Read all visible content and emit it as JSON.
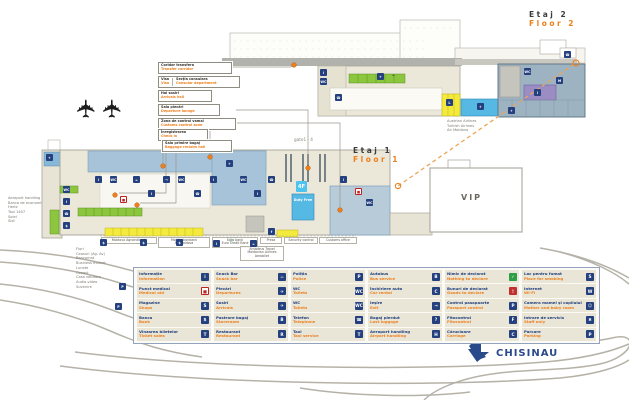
{
  "floors": {
    "floor2": {
      "ro": "Etaj 2",
      "en": "Floor 2"
    },
    "floor1": {
      "ro": "Etaj 1",
      "en": "Floor 1"
    }
  },
  "callouts": [
    {
      "ro": "Coridor transfera",
      "en": "Transfer corridor"
    },
    {
      "ro": "Visa",
      "en": "Visa",
      "ro2": "Secția consulara",
      "en2": "Consular department"
    },
    {
      "ro": "Hol sosiri",
      "en": "Arrivals hall"
    },
    {
      "ro": "Sala plecări",
      "en": "Departure lounge"
    },
    {
      "ro": "Zona de control vamal",
      "en": "Customs control zone"
    },
    {
      "ro": "Înregistrarea",
      "en": "Check in"
    },
    {
      "ro": "Sala primire bagaj",
      "en": "Baggage reclaim hall"
    }
  ],
  "annotations": {
    "gate_label": "gate1 - 4",
    "vip": "VIP",
    "city": "CHISINAU",
    "duty_free": "Duty Free",
    "airlines_note": [
      "Austrian Airlines",
      "Turkish Airlines",
      "Air Moldova"
    ],
    "services_list": [
      "Aeroport handling",
      "Banca de economii",
      "Hertz",
      "Taxi 1407",
      "Solei",
      "Sixt"
    ],
    "shops_list": [
      "Flori",
      "Ceasuri (Ag. Av)",
      "Bancomat",
      "Business market"
    ],
    "shops_list2": [
      "Lunete",
      "Conact",
      "Casa valutara",
      "Audio-video",
      "Suvenire"
    ],
    "tenant_labels": [
      {
        "lines": [
          "Moldova Agroindbank"
        ]
      },
      {
        "lines": [
          "Moldindconbank",
          "Air Moldova"
        ]
      },
      {
        "lines": [
          "Euro bank",
          "Euro Credit Bank"
        ]
      },
      {
        "lines": [
          "Presa"
        ]
      },
      {
        "lines": [
          "Amadeus Travel",
          "Moldavian Airlines",
          "Aerobilet"
        ]
      },
      {
        "lines": [
          "Security control"
        ]
      },
      {
        "lines": [
          "Customs office"
        ]
      }
    ]
  },
  "legend": {
    "columns": [
      {
        "items": [
          {
            "ro": "Informație",
            "en": "Information",
            "icon": "information",
            "glyph": "i",
            "bg": "#24407e",
            "fg": "#ffffff"
          },
          {
            "ro": "Punct medical",
            "en": "Medical aid",
            "icon": "medical-aid",
            "glyph": "■",
            "bg": "#ffffff",
            "fg": "#c02222"
          },
          {
            "ro": "Magazine",
            "en": "Shops",
            "icon": "shops",
            "glyph": "S",
            "bg": "#24407e",
            "fg": "#ffffff"
          },
          {
            "ro": "Banca",
            "en": "Bank",
            "icon": "bank",
            "glyph": "$",
            "bg": "#24407e",
            "fg": "#ffffff"
          },
          {
            "ro": "Vînzarea biletelor",
            "en": "Ticket sales",
            "icon": "ticket-sales",
            "glyph": "T",
            "bg": "#24407e",
            "fg": "#ffffff"
          }
        ]
      },
      {
        "items": [
          {
            "ro": "Snack Bar",
            "en": "Snack bar",
            "icon": "snack-bar",
            "glyph": "☕",
            "bg": "#24407e",
            "fg": "#ffffff"
          },
          {
            "ro": "Plecări",
            "en": "Departures",
            "icon": "departures",
            "glyph": "✈",
            "bg": "#24407e",
            "fg": "#ffffff"
          },
          {
            "ro": "Sosiri",
            "en": "Arrivals",
            "icon": "arrivals",
            "glyph": "✈",
            "bg": "#24407e",
            "fg": "#ffffff"
          },
          {
            "ro": "Pastrare bagaj",
            "en": "Storeroom",
            "icon": "luggage-storage",
            "glyph": "B",
            "bg": "#24407e",
            "fg": "#ffffff"
          },
          {
            "ro": "Restaurant",
            "en": "Restaurant",
            "icon": "restaurant",
            "glyph": "R",
            "bg": "#24407e",
            "fg": "#ffffff"
          }
        ]
      },
      {
        "items": [
          {
            "ro": "Poliția",
            "en": "Police",
            "icon": "police",
            "glyph": "P",
            "bg": "#24407e",
            "fg": "#ffffff"
          },
          {
            "ro": "WC",
            "en": "Toilets",
            "icon": "wc-men",
            "glyph": "WC",
            "bg": "#24407e",
            "fg": "#ffffff"
          },
          {
            "ro": "WC",
            "en": "Toilets",
            "icon": "wc-women",
            "glyph": "WC",
            "bg": "#24407e",
            "fg": "#ffffff"
          },
          {
            "ro": "Telefon",
            "en": "Telephone",
            "icon": "telephone",
            "glyph": "☎",
            "bg": "#24407e",
            "fg": "#ffffff"
          },
          {
            "ro": "Taxi",
            "en": "Taxi service",
            "icon": "taxi",
            "glyph": "T",
            "bg": "#24407e",
            "fg": "#ffffff"
          }
        ]
      },
      {
        "items": [
          {
            "ro": "Autobus",
            "en": "Bus service",
            "icon": "bus",
            "glyph": "B",
            "bg": "#24407e",
            "fg": "#ffffff"
          },
          {
            "ro": "Închiriere auto",
            "en": "Car rental",
            "icon": "car-rental",
            "glyph": "C",
            "bg": "#24407e",
            "fg": "#ffffff"
          },
          {
            "ro": "Ieşire",
            "en": "Exit",
            "icon": "exit",
            "glyph": "→",
            "bg": "#24407e",
            "fg": "#ffffff"
          },
          {
            "ro": "Bagaj pierdut",
            "en": "Lost luggage",
            "icon": "lost-luggage",
            "glyph": "?",
            "bg": "#24407e",
            "fg": "#ffffff"
          },
          {
            "ro": "Aeroport handling",
            "en": "Airport handling",
            "icon": "airport-handling",
            "glyph": "H",
            "bg": "#24407e",
            "fg": "#ffffff"
          }
        ]
      },
      {
        "items": [
          {
            "ro": "Nimic de declarat",
            "en": "Nothing to declare",
            "icon": "nothing-to-declare",
            "glyph": "✓",
            "bg": "#2f9e44",
            "fg": "#ffffff"
          },
          {
            "ro": "Bunuri de declarat",
            "en": "Goods to declare",
            "icon": "goods-to-declare",
            "glyph": "!",
            "bg": "#c03030",
            "fg": "#ffffff"
          },
          {
            "ro": "Control pasapoarte",
            "en": "Passport control",
            "icon": "passport-control",
            "glyph": "P",
            "bg": "#24407e",
            "fg": "#ffffff"
          },
          {
            "ro": "Fitocontrol",
            "en": "Fitocontrol",
            "icon": "fitocontrol",
            "glyph": "F",
            "bg": "#24407e",
            "fg": "#ffffff"
          },
          {
            "ro": "Cărucioare",
            "en": "Carriage",
            "icon": "trolleys",
            "glyph": "C",
            "bg": "#24407e",
            "fg": "#ffffff"
          }
        ]
      },
      {
        "items": [
          {
            "ro": "Loc pentru fumat",
            "en": "Place for smoking",
            "icon": "smoking-area",
            "glyph": "S",
            "bg": "#24407e",
            "fg": "#ffffff"
          },
          {
            "ro": "Internet",
            "en": "Wi-Fi",
            "icon": "wifi",
            "glyph": "W",
            "bg": "#24407e",
            "fg": "#ffffff"
          },
          {
            "ro": "Camera mamei şi copilului",
            "en": "Mother and baby room",
            "icon": "mother-baby-room",
            "glyph": "☺",
            "bg": "#24407e",
            "fg": "#ffffff"
          },
          {
            "ro": "Intrare de serviciu",
            "en": "Staff only",
            "icon": "staff-entrance",
            "glyph": "✖",
            "bg": "#24407e",
            "fg": "#ffffff"
          },
          {
            "ro": "Parcare",
            "en": "Parking",
            "icon": "parking",
            "glyph": "P",
            "bg": "#24407e",
            "fg": "#ffffff"
          }
        ]
      }
    ]
  },
  "map_icons": [
    {
      "name": "information",
      "x": 320,
      "y": 69,
      "g": "i",
      "bg": "#24407e",
      "fg": "#fff"
    },
    {
      "name": "wc",
      "x": 320,
      "y": 78,
      "g": "WC",
      "bg": "#24407e",
      "fg": "#fff"
    },
    {
      "name": "telephone",
      "x": 335,
      "y": 94,
      "g": "☎",
      "bg": "#24407e",
      "fg": "#fff"
    },
    {
      "name": "departures",
      "x": 377,
      "y": 73,
      "g": "✈",
      "bg": "#24407e",
      "fg": "#fff"
    },
    {
      "name": "snack-bar",
      "x": 390,
      "y": 71,
      "g": "☕",
      "bg": "transparent",
      "fg": "#333"
    },
    {
      "name": "lift",
      "x": 446,
      "y": 99,
      "g": "L",
      "bg": "#24407e",
      "fg": "#fff"
    },
    {
      "name": "departures",
      "x": 477,
      "y": 103,
      "g": "✈",
      "bg": "#24407e",
      "fg": "#fff"
    },
    {
      "name": "wc",
      "x": 524,
      "y": 68,
      "g": "WC",
      "bg": "#24407e",
      "fg": "#fff"
    },
    {
      "name": "mother-baby",
      "x": 556,
      "y": 77,
      "g": "M",
      "bg": "#24407e",
      "fg": "#fff"
    },
    {
      "name": "information",
      "x": 534,
      "y": 89,
      "g": "i",
      "bg": "#24407e",
      "fg": "#fff"
    },
    {
      "name": "departures",
      "x": 508,
      "y": 107,
      "g": "✈",
      "bg": "#24407e",
      "fg": "#fff"
    },
    {
      "name": "telephone",
      "x": 564,
      "y": 51,
      "g": "☎",
      "bg": "#24407e",
      "fg": "#fff"
    },
    {
      "name": "arrivals",
      "x": 46,
      "y": 154,
      "g": "✈",
      "bg": "#24407e",
      "fg": "#fff"
    },
    {
      "name": "wc",
      "x": 63,
      "y": 186,
      "g": "WC",
      "bg": "#24407e",
      "fg": "#fff"
    },
    {
      "name": "information",
      "x": 63,
      "y": 198,
      "g": "i",
      "bg": "#24407e",
      "fg": "#fff"
    },
    {
      "name": "telephone",
      "x": 63,
      "y": 210,
      "g": "☎",
      "bg": "#24407e",
      "fg": "#fff"
    },
    {
      "name": "bank",
      "x": 63,
      "y": 222,
      "g": "$",
      "bg": "#24407e",
      "fg": "#fff"
    },
    {
      "name": "information",
      "x": 95,
      "y": 176,
      "g": "i",
      "bg": "#24407e",
      "fg": "#fff"
    },
    {
      "name": "wc",
      "x": 110,
      "y": 176,
      "g": "WC",
      "bg": "#24407e",
      "fg": "#fff"
    },
    {
      "name": "medical",
      "x": 120,
      "y": 196,
      "g": "■",
      "bg": "#fff",
      "fg": "#c02222"
    },
    {
      "name": "snack-bar",
      "x": 133,
      "y": 176,
      "g": "☕",
      "bg": "#24407e",
      "fg": "#fff"
    },
    {
      "name": "information",
      "x": 148,
      "y": 190,
      "g": "i",
      "bg": "#24407e",
      "fg": "#fff"
    },
    {
      "name": "exit",
      "x": 163,
      "y": 176,
      "g": "→",
      "bg": "#24407e",
      "fg": "#fff"
    },
    {
      "name": "wc",
      "x": 178,
      "y": 176,
      "g": "WC",
      "bg": "#24407e",
      "fg": "#fff"
    },
    {
      "name": "telephone",
      "x": 194,
      "y": 190,
      "g": "☎",
      "bg": "#24407e",
      "fg": "#fff"
    },
    {
      "name": "information",
      "x": 210,
      "y": 176,
      "g": "i",
      "bg": "#24407e",
      "fg": "#fff"
    },
    {
      "name": "departures",
      "x": 226,
      "y": 160,
      "g": "✈",
      "bg": "#24407e",
      "fg": "#fff"
    },
    {
      "name": "wc",
      "x": 240,
      "y": 176,
      "g": "WC",
      "bg": "#24407e",
      "fg": "#fff"
    },
    {
      "name": "information",
      "x": 254,
      "y": 190,
      "g": "i",
      "bg": "#24407e",
      "fg": "#fff"
    },
    {
      "name": "telephone",
      "x": 268,
      "y": 176,
      "g": "☎",
      "bg": "#24407e",
      "fg": "#fff"
    },
    {
      "name": "gate-lift",
      "x": 296,
      "y": 181,
      "g": "4F",
      "bg": "#4fc3f0",
      "fg": "#fff",
      "s": 11
    },
    {
      "name": "information",
      "x": 340,
      "y": 176,
      "g": "i",
      "bg": "#24407e",
      "fg": "#fff"
    },
    {
      "name": "medical",
      "x": 355,
      "y": 188,
      "g": "■",
      "bg": "#fff",
      "fg": "#c02222"
    },
    {
      "name": "wc",
      "x": 366,
      "y": 199,
      "g": "WC",
      "bg": "#24407e",
      "fg": "#fff"
    },
    {
      "name": "bank",
      "x": 100,
      "y": 239,
      "g": "$",
      "bg": "#24407e",
      "fg": "#fff"
    },
    {
      "name": "bank",
      "x": 140,
      "y": 239,
      "g": "$",
      "bg": "#24407e",
      "fg": "#fff"
    },
    {
      "name": "bank",
      "x": 176,
      "y": 239,
      "g": "$",
      "bg": "#24407e",
      "fg": "#fff"
    },
    {
      "name": "information",
      "x": 213,
      "y": 240,
      "g": "i",
      "bg": "#24407e",
      "fg": "#fff"
    },
    {
      "name": "social",
      "x": 268,
      "y": 228,
      "g": "f",
      "bg": "#24407e",
      "fg": "#fff"
    },
    {
      "name": "snack-bar",
      "x": 250,
      "y": 240,
      "g": "☕",
      "bg": "#24407e",
      "fg": "#fff"
    },
    {
      "name": "parking",
      "x": 119,
      "y": 283,
      "g": "P",
      "bg": "#24407e",
      "fg": "#fff"
    },
    {
      "name": "parking",
      "x": 115,
      "y": 303,
      "g": "P",
      "bg": "#24407e",
      "fg": "#fff"
    }
  ],
  "colors": {
    "accent_orange": "#ee7f1d",
    "navy": "#24407e",
    "green": "#8cc63e",
    "yellow": "#f3ea3d",
    "lightblue": "#a6c3da",
    "cyan": "#56b9e4",
    "purple": "#9c8cc4",
    "beige": "#ebe7d9",
    "road": "#b5b2a8"
  }
}
